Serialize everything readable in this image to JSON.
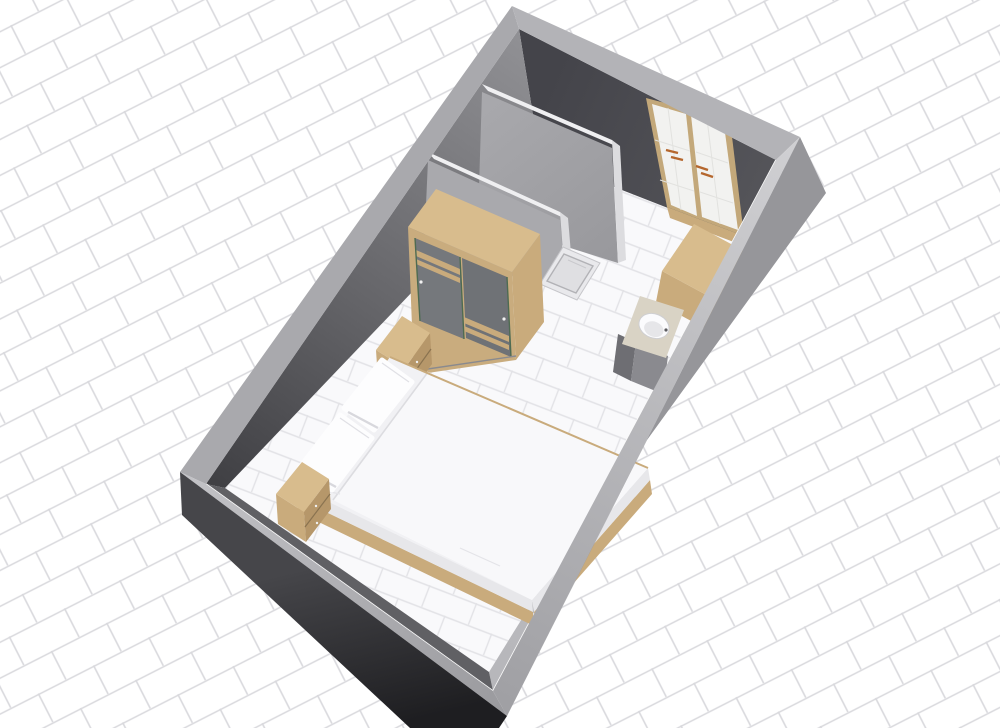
{
  "scene": {
    "type": "3d-floor-plan",
    "view": "aerial-perspective",
    "room": "bedroom-with-shower-nook"
  },
  "objects": {
    "door": "double-french-door",
    "wardrobe": "sliding-door-wardrobe",
    "bed": "double-bed-with-pillows",
    "nightstand_right": "nightstand-two-drawers",
    "nightstand_left": "nightstand-two-drawers",
    "counter": "corner-wood-counter",
    "vanity": "washbasin-cabinet",
    "shower": "shower-tray",
    "partition_a": "partition-wall-front",
    "partition_b": "partition-wall-back"
  },
  "colors": {
    "bg": "#ffffff",
    "bg_grout": "#d9d9dd",
    "floor": "#f9f9fb",
    "floor_grout": "#e2e2e6",
    "band_nw": "#a9a9ad",
    "band_ne": "#b3b3b7",
    "band_es_light": "#cfcfd2",
    "band_es_dark": "#a0a0a4",
    "band_ws_light": "#c2c2c6",
    "band_ws_dark": "#9b9b9f",
    "outer_dark_top": "#46464a",
    "outer_dark_bottom": "#1e1e21",
    "outer_right": "#96969a",
    "wall_left_light": "#919195",
    "wall_left_mid": "#66666a",
    "wall_left_dark": "#3f3f43",
    "wall_right_a": "#44444a",
    "wall_right_b": "#55555a",
    "near_right_light": "#cdcdd0",
    "near_right_dark": "#b7b7bb",
    "near_left_face": "#606064",
    "baseboard": "#fafafa",
    "partition_face": "#a9a9ad",
    "partition_face_dark": "#98989c",
    "partition_top": "#efeff1",
    "partition_end": "#dcdcdf",
    "shower_rim": "#e9e9ec",
    "shower_inner": "#dfdfe2",
    "shower_line": "#b2b2b6",
    "wood_top": "#d8bc8d",
    "wood_mid": "#c9ab7c",
    "wood_dark": "#b6976a",
    "wood_frame": "#c9ac7e",
    "door_frame": "#c3a87a",
    "door_panel": "#f2f2f0",
    "door_panel_line": "#e2e2df",
    "handle_copper": "#b5672e",
    "wardrobe_door": "#75787c",
    "wardrobe_door2": "#6f7276",
    "wardrobe_edge_green": "#4e6b52",
    "drawer_line": "#8a7350",
    "mattress": "#f1f1f4",
    "mattress_light": "#f8f8fa",
    "mattress_crease": "#dcdce0",
    "bed_side": "#e7e7ea",
    "pillow": "#fdfdfe",
    "pillow_edge": "#e0e0e5",
    "pillow_shadow": "#d8d8dd",
    "vanity_top": "#d9d3c5",
    "basin": "#fbfbfd",
    "basin_shadow": "#e6e6e9",
    "basin_rim": "#cfcfd2",
    "cabinet_front": "#8a8a8f",
    "cabinet_side": "#6e6e73"
  }
}
